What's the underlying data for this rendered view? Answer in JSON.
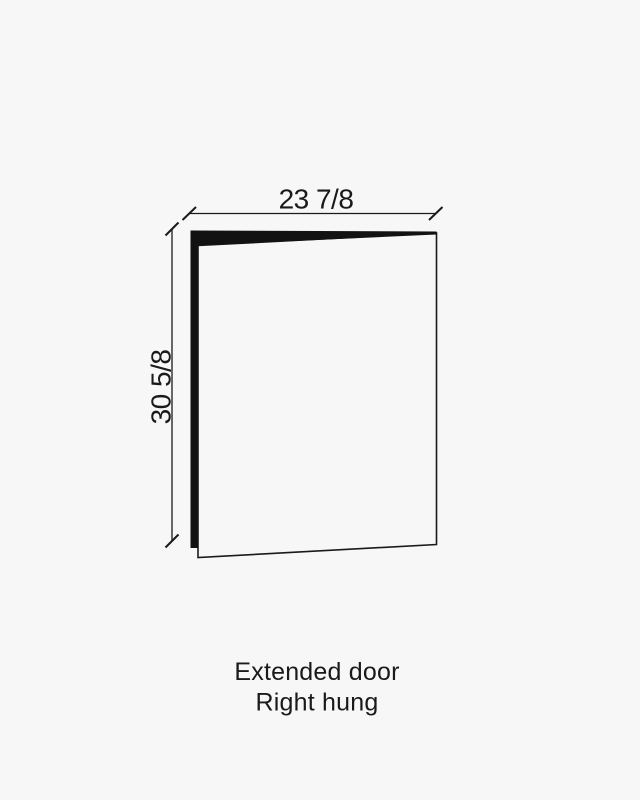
{
  "colors": {
    "background": "#f7f7f7",
    "ink": "#1a1a1a",
    "edge_fill": "#121212"
  },
  "diagram": {
    "type": "door-elevation-drawing",
    "width_dimension": "23 7/8",
    "height_dimension": "30 5/8"
  },
  "caption": {
    "line1": "Extended door",
    "line2": "Right hung"
  }
}
